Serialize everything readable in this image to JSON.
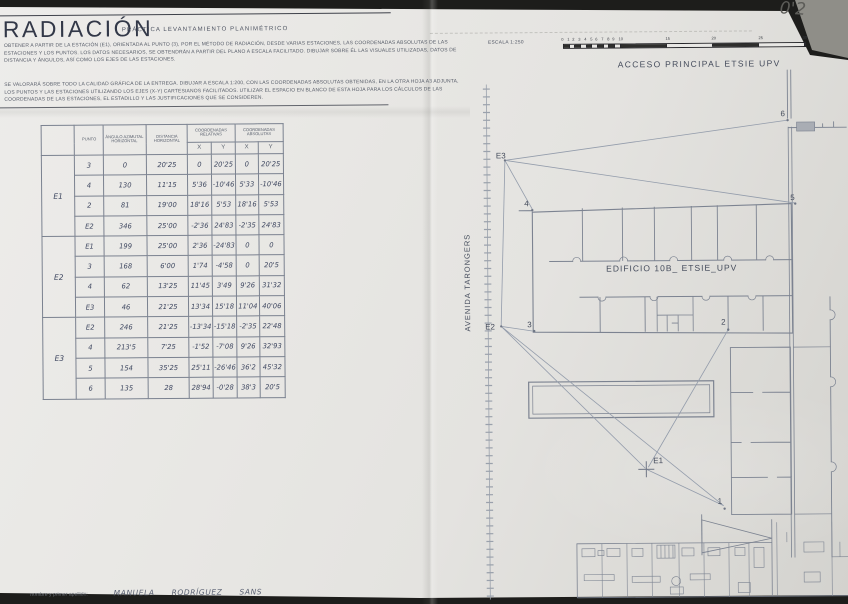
{
  "header": {
    "title": "RADIACIÓN",
    "subtitle": "PRÁCTICA  LEVANTAMIENTO  PLANIMÉTRICO",
    "paragraph1": "OBTENER A PARTIR DE LA ESTACIÓN (E1), ORIENTADA AL PUNTO (3), POR EL MÉTODO DE RADIACIÓN, DESDE VARIAS ESTACIONES, LAS COORDENADAS ABSOLUTAS DE LAS ESTACIONES Y LOS PUNTOS. LOS DATOS NECESARIOS, SE OBTENDRÁN A PARTIR DEL PLANO A ESCALA FACILITADO. DIBUJAR SOBRE ÉL LAS VISUALES UTILIZADAS, DATOS DE DISTANCIA Y ÁNGULOS, ASÍ COMO LOS EJES DE LAS ESTACIONES.",
    "paragraph2": "SE VALORARÁ SOBRE TODO LA CALIDAD GRÁFICA DE LA ENTREGA. DIBUJAR A ESCALA 1:200, CON LAS COORDENADAS ABSOLUTAS OBTENIDAS, EN LA OTRA HOJA A3 ADJUNTA, LOS PUNTOS Y LAS ESTACIONES UTILIZANDO LOS EJES (X-Y) CARTESIANOS FACILITADOS. UTILIZAR EL ESPACIO EN BLANCO DE ESTA HOJA PARA LOS CÁLCULOS DE LAS COORDENADAS DE LAS ESTACIONES, EL ESTADILLO Y LAS JUSTIFICACIONES QUE SE CONSIDEREN.",
    "grade": "0'2"
  },
  "scalebar": {
    "label": "ESCALA 1:250",
    "ticks": [
      "0",
      "1",
      "2",
      "3",
      "4",
      "5",
      "6",
      "7",
      "8",
      "9",
      "10",
      "15",
      "20",
      "25",
      "30"
    ]
  },
  "table": {
    "headers": {
      "punto": "PUNTO",
      "angulo": "ÁNGULO AZIMUTAL HORIZONTAL",
      "distancia": "DISTANCIA HORIZONTAL",
      "coord_rel": "COORDENADAS RELATIVAS",
      "coord_abs": "COORDENADAS ABSOLUTAS",
      "x": "X",
      "y": "Y"
    },
    "groups": [
      {
        "station": "E1",
        "rows": [
          [
            "3",
            "0",
            "20'25",
            "0",
            "20'25",
            "0",
            "20'25"
          ],
          [
            "4",
            "130",
            "11'15",
            "5'36",
            "-10'46",
            "5'33",
            "-10'46"
          ],
          [
            "2",
            "81",
            "19'00",
            "18'16",
            "5'53",
            "18'16",
            "5'53"
          ],
          [
            "E2",
            "346",
            "25'00",
            "-2'36",
            "24'83",
            "-2'35",
            "24'83"
          ]
        ]
      },
      {
        "station": "E2",
        "rows": [
          [
            "E1",
            "199",
            "25'00",
            "2'36",
            "-24'83",
            "0",
            "0"
          ],
          [
            "3",
            "168",
            "6'00",
            "1'74",
            "-4'58",
            "0",
            "20'5"
          ],
          [
            "4",
            "62",
            "13'25",
            "11'45",
            "3'49",
            "9'26",
            "31'32"
          ],
          [
            "E3",
            "46",
            "21'25",
            "13'34",
            "15'18",
            "11'04",
            "40'06"
          ]
        ]
      },
      {
        "station": "E3",
        "rows": [
          [
            "E2",
            "246",
            "21'25",
            "-13'34",
            "-15'18",
            "-2'35",
            "22'48"
          ],
          [
            "4",
            "213'5",
            "7'25",
            "-1'52",
            "-7'08",
            "9'26",
            "32'93"
          ],
          [
            "5",
            "154",
            "35'25",
            "25'11",
            "-26'46",
            "36'2",
            "45'32"
          ],
          [
            "6",
            "135",
            "28",
            "28'94",
            "-0'28",
            "38'3",
            "20'5"
          ]
        ]
      }
    ]
  },
  "plan": {
    "labels": {
      "acceso": "ACCESO PRINCIPAL ETSIE UPV",
      "avenida": "AVENIDA TARONGERS",
      "edificio": "EDIFICIO 10B_ ETSIE_UPV"
    },
    "points": {
      "e1": "E1",
      "e2": "E2",
      "e3": "E3",
      "p1": "1",
      "p2": "2",
      "p3": "3",
      "p4": "4",
      "p5": "5",
      "p6": "6"
    }
  },
  "footer": {
    "label": "nombre y primer apellido:",
    "value": "MANUELA  RODRÍGUEZ  SANS"
  },
  "colors": {
    "ink": "#3e4760",
    "wall": "#7c8391",
    "pencil": "#5c5c58",
    "paper": "#e8e7e4"
  }
}
